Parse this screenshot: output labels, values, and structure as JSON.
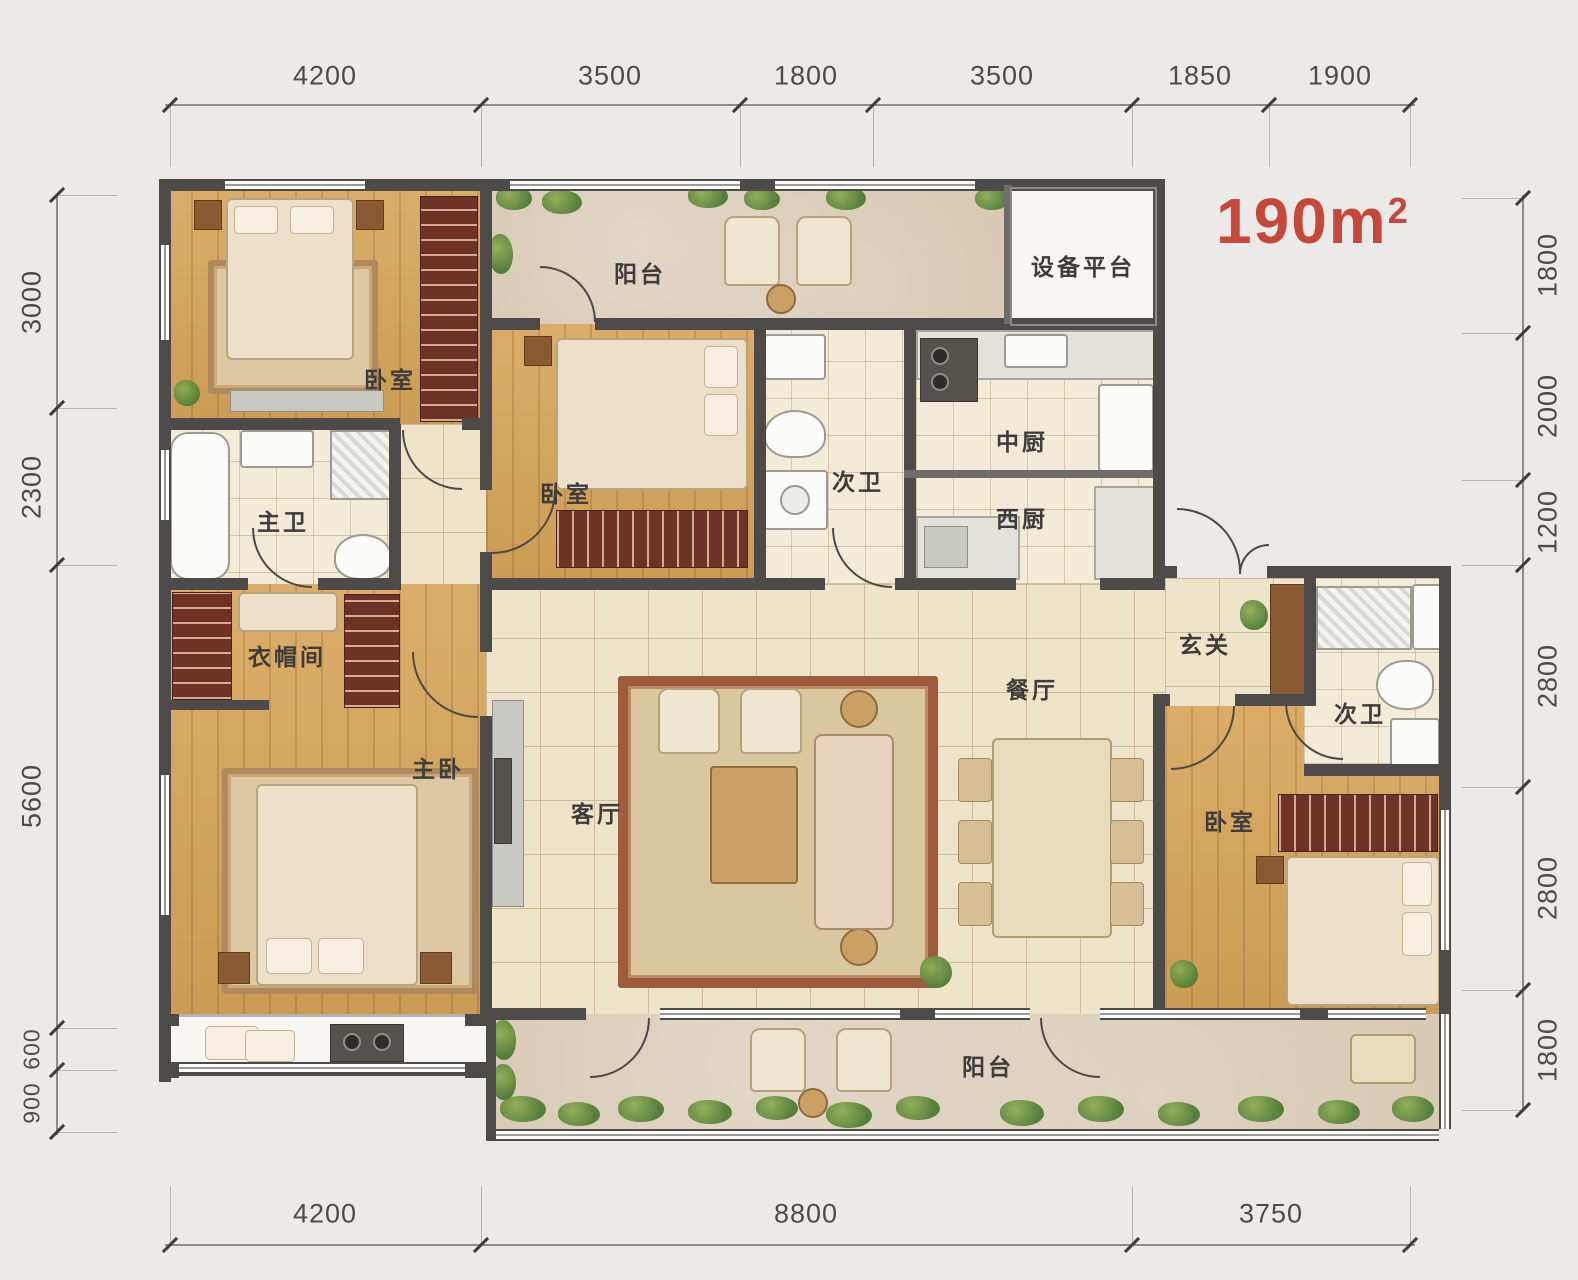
{
  "area": {
    "number": "190",
    "unit": "m",
    "exponent": "2"
  },
  "rooms": {
    "bedroom_top_left": "卧室",
    "balcony_top": "阳台",
    "equipment_platform": "设备平台",
    "master_bath": "主卫",
    "bedroom_second": "卧室",
    "bath_mid": "次卫",
    "kitchen_chinese": "中厨",
    "kitchen_western": "西厨",
    "cloakroom": "衣帽间",
    "master_bedroom": "主卧",
    "living_room": "客厅",
    "dining_room": "餐厅",
    "foyer": "玄关",
    "bath_right": "次卫",
    "bedroom_right": "卧室",
    "balcony_bottom": "阳台"
  },
  "dimensions": {
    "top": [
      "4200",
      "3500",
      "1800",
      "3500",
      "1850",
      "1900"
    ],
    "bottom": [
      "4200",
      "8800",
      "3750"
    ],
    "left": [
      "3000",
      "2300",
      "5600",
      "600",
      "900"
    ],
    "right": [
      "1800",
      "2000",
      "1200",
      "2800",
      "2800",
      "1800"
    ]
  },
  "colors": {
    "area_accent": "#c5483b",
    "wall": "#4c4b49"
  }
}
